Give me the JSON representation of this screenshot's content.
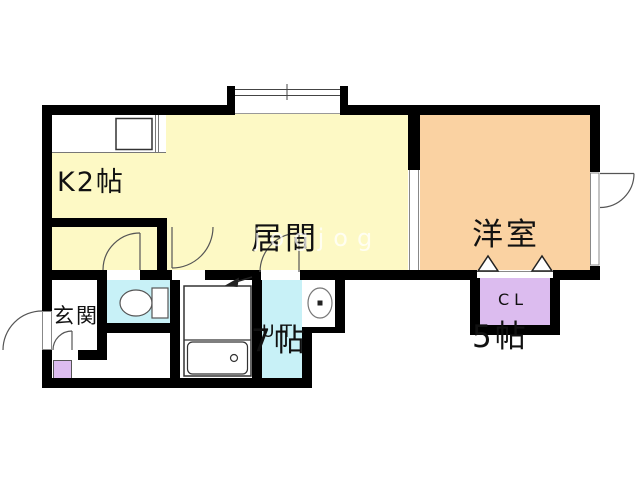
{
  "rooms": {
    "kitchen": {
      "label": "K2帖"
    },
    "living": {
      "line1": "居間",
      "line2": "7帖"
    },
    "western": {
      "line1": "洋室",
      "line2": "5帖"
    },
    "entrance": {
      "label": "玄関"
    },
    "utility": {
      "label": "UT"
    },
    "closet": {
      "label": "CL"
    }
  },
  "watermark": {
    "text": "jogjog"
  },
  "colors": {
    "wall": "#000000",
    "room_yellow": "#FDF9C5",
    "room_orange": "#FAD2A2",
    "room_cyan": "#C8F1F7",
    "room_purple": "#DCBCEF",
    "fixture_outline": "#555555",
    "background": "#FFFFFF"
  },
  "fixtures": [
    "kitchen-counter",
    "kitchen-sink",
    "bay-window",
    "toilet",
    "unit-bath",
    "bathtub",
    "bath-drain",
    "washing-machine",
    "shoe-cabinet",
    "entry-door",
    "room-doors",
    "closet-double-doors"
  ]
}
